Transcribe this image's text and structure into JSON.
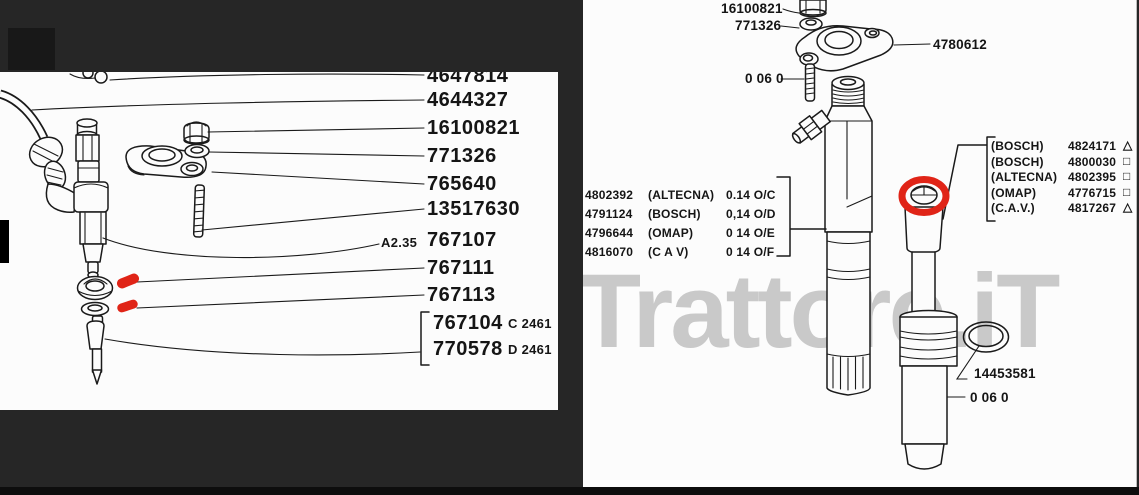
{
  "colors": {
    "paper": "#fcfcfc",
    "ink": "#1a1a1a",
    "annotation_red": "#e02417",
    "watermark_gray": "#c9c9c9",
    "background": "#262626"
  },
  "watermark": "Trattore.iT",
  "left_diagram": {
    "description": "injector exploded view",
    "part_labels": [
      {
        "text": "4647814"
      },
      {
        "text": "4644327"
      },
      {
        "text": "16100821"
      },
      {
        "text": "771326"
      },
      {
        "text": "765640"
      },
      {
        "text": "13517630"
      },
      {
        "prefix": "A2.35",
        "text": "767107"
      },
      {
        "text": "767111"
      },
      {
        "text": "767113"
      },
      {
        "text": "767104",
        "suffix": "C 2461"
      },
      {
        "text": "770578",
        "suffix": "D 2461"
      }
    ]
  },
  "right_diagram": {
    "description": "injector body and nozzle holder exploded view",
    "top_labels": [
      {
        "text": "16100821"
      },
      {
        "text": "771326"
      },
      {
        "text": "4780612"
      },
      {
        "text": "0 06 0"
      }
    ],
    "variant_table_left": {
      "rows": [
        {
          "part": "4802392",
          "maker": "(ALTECNA)",
          "spec": "0.14 O/C"
        },
        {
          "part": "4791124",
          "maker": "(BOSCH)",
          "spec": "0,14 O/D"
        },
        {
          "part": "4796644",
          "maker": "(OMAP)",
          "spec": "0 14 O/E"
        },
        {
          "part": "4816070",
          "maker": "(C A V)",
          "spec": "0 14 O/F"
        }
      ]
    },
    "variant_table_right": {
      "rows": [
        {
          "maker": "(BOSCH)",
          "part": "4824171",
          "symbol": "△"
        },
        {
          "maker": "(BOSCH)",
          "part": "4800030",
          "symbol": "□"
        },
        {
          "maker": "(ALTECNA)",
          "part": "4802395",
          "symbol": "□"
        },
        {
          "maker": "(OMAP)",
          "part": "4776715",
          "symbol": "□"
        },
        {
          "maker": "(C.A.V.)",
          "part": "4817267",
          "symbol": "△"
        }
      ]
    },
    "bottom_labels": [
      {
        "text": "14453581"
      },
      {
        "text": "0 06 0"
      }
    ]
  }
}
